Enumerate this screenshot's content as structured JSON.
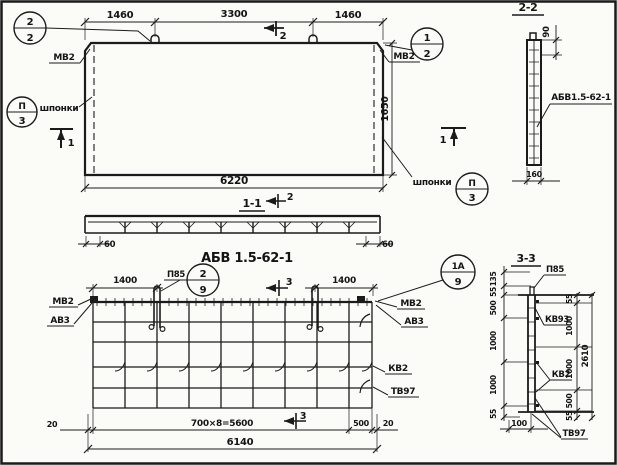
{
  "sheet": {
    "plan": {
      "dim_top_left": "1460",
      "dim_top_mid": "3300",
      "dim_top_right": "1460",
      "dim_width": "6220",
      "dim_height": "1650",
      "label_mv2_left": "МВ2",
      "label_mv2_right": "МВ2",
      "label_keys_left": "шпонки",
      "label_keys_right": "шпонки",
      "callout_top_left": {
        "num": "2",
        "den": "2"
      },
      "callout_top_right": {
        "num": "1",
        "den": "2"
      },
      "callout_keys_left": {
        "num": "П",
        "den": "3"
      },
      "callout_keys_right": {
        "num": "П",
        "den": "3"
      },
      "section_mark_1_left": "1",
      "section_mark_1_right": "1",
      "section_mark_2": "2"
    },
    "section_1_1": {
      "title": "1-1",
      "section_mark_2": "2",
      "dim_end_left": "60",
      "dim_end_right": "60"
    },
    "main_title": "АБВ 1.5-62-1",
    "section_2_2": {
      "title": "2-2",
      "dim_hook_offset": "90",
      "panel_mark": "АБВ1.5-62-1",
      "dim_thickness": "160"
    },
    "rebar_plan": {
      "dim_loop_left": "1400",
      "dim_loop_right": "1400",
      "label_loop": "П85",
      "callout_loop": {
        "num": "2",
        "den": "9"
      },
      "callout_corner": {
        "num": "1А",
        "den": "9"
      },
      "label_mv2_left": "МВ2",
      "label_av3_left": "АВ3",
      "label_mv2_right": "МВ2",
      "label_av3_right": "АВ3",
      "label_kv2": "КВ2",
      "label_tv97": "ТВ97",
      "section_mark_3_top": "3",
      "section_mark_3_bottom": "3",
      "dim_margin_left": "20",
      "dim_spacing": "700×8=5600",
      "dim_end_right": "500",
      "dim_margin_right": "20",
      "dim_total": "6140"
    },
    "section_3_3": {
      "title": "3-3",
      "label_loop": "П85",
      "label_kv93": "КВ93",
      "label_kv2": "КВ2",
      "label_tv97": "ТВ97",
      "dims_left": [
        "135",
        "55",
        "500",
        "1000",
        "1000",
        "55"
      ],
      "dims_right": [
        "55",
        "1000",
        "1000",
        "500",
        "55"
      ],
      "dim_total": "2610",
      "dim_width": "100"
    }
  }
}
